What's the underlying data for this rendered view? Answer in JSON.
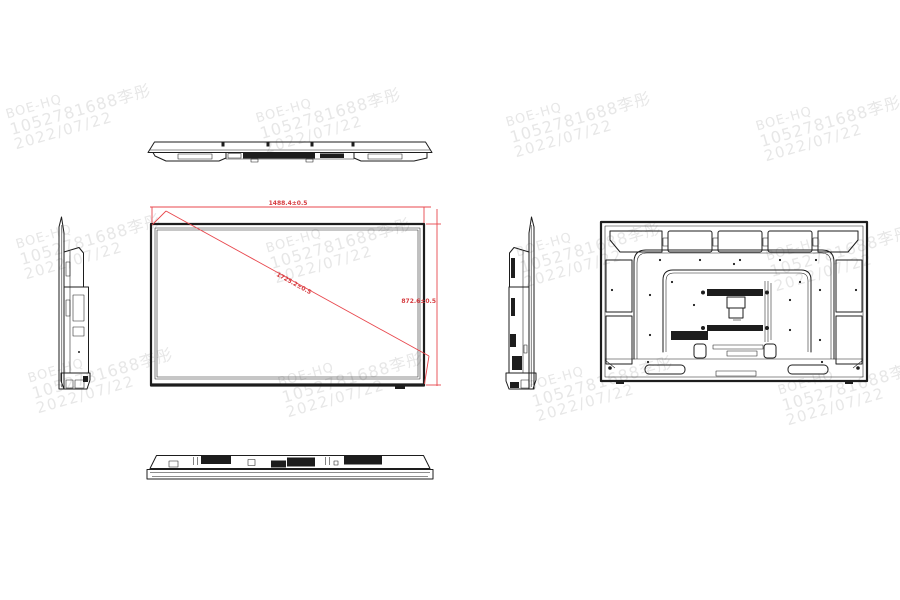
{
  "document": {
    "kind": "monitor-mechanical-drawing"
  },
  "watermark": {
    "line1": "BOE-HQ",
    "line2": "1052781688李彤",
    "line3": "2022/07/22",
    "color": "#e7e7e7"
  },
  "front_view": {
    "dim_width": "1488.4±0.5",
    "dim_height": "872.6±0.5",
    "dim_diagonal": "1725.2±0.5"
  },
  "colors": {
    "line": "#1d1d1d",
    "dimension_red": "#e8474d",
    "background": "#ffffff"
  }
}
